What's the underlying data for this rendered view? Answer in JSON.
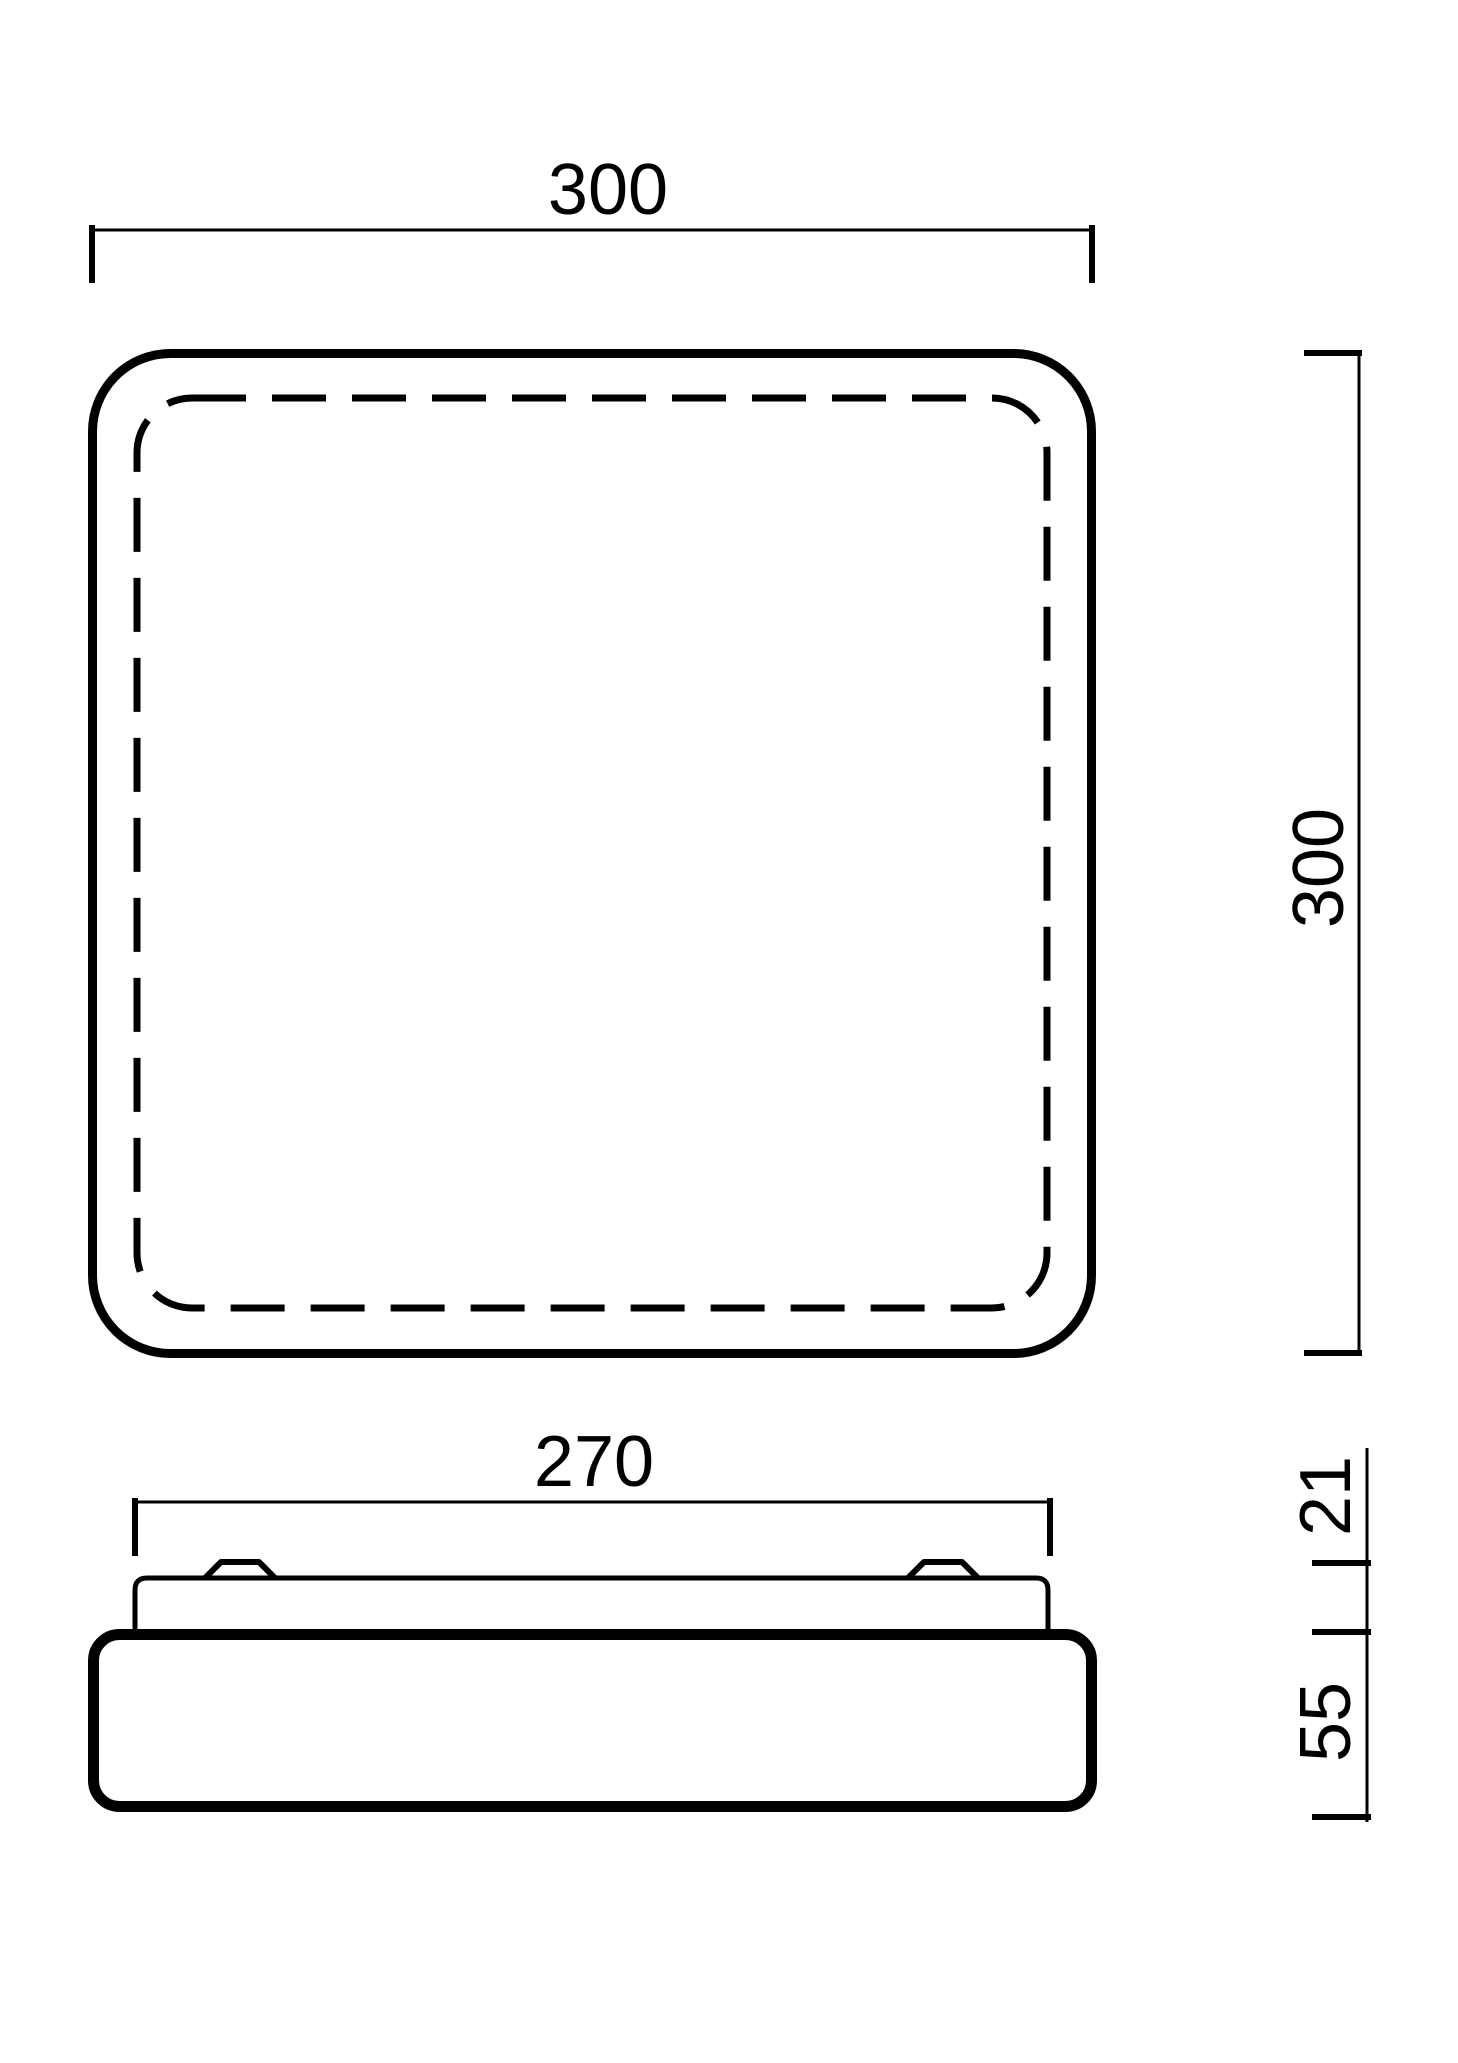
{
  "drawing": {
    "paper_color": "#ffffff",
    "ink_color": "#000000",
    "top_view": {
      "width_label": "300",
      "height_label": "300"
    },
    "side_view": {
      "width_label": "270",
      "upper_height_label": "21",
      "body_height_label": "55"
    }
  }
}
